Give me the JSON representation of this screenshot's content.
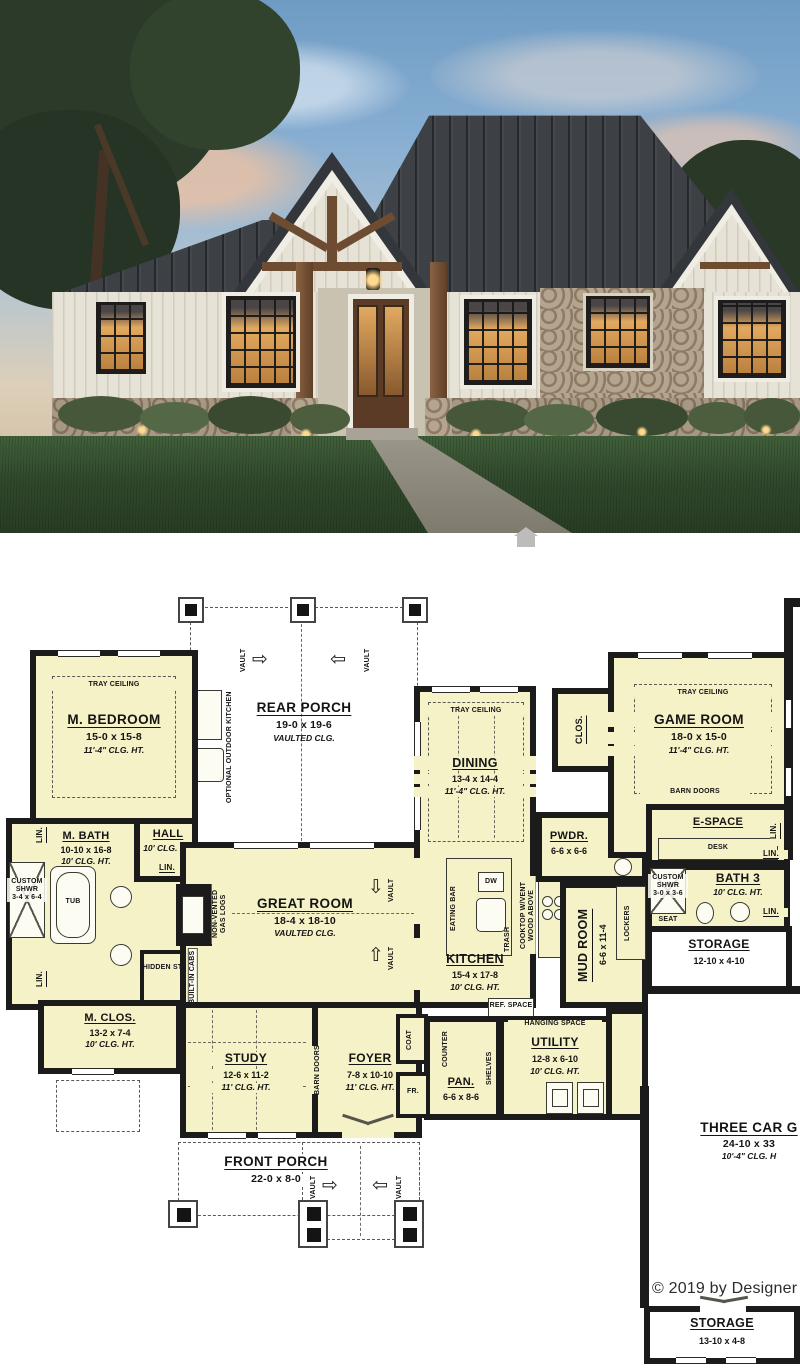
{
  "photo": {
    "description": "Dusk exterior rendering of a modern farmhouse ranch house with dark metal roof, white board-and-batten siding, timber porch and stone accents",
    "palette": {
      "sky_top": "#6f9cc4",
      "sky_horizon": "#e5d3b8",
      "roof": "#3d4145",
      "siding": "#e6e2d6",
      "stone": "#998672",
      "lawn": "#2f4629",
      "window_glow": "#dda55c",
      "timber": "#7a553a"
    },
    "watermark_icon": "house-icon"
  },
  "plan": {
    "wall_color": "#1b1b1b",
    "room_fill": "#f5f2c7",
    "rooms": {
      "m_bedroom": {
        "name": "M. BEDROOM",
        "dim": "15-0 x 15-8",
        "clg": "11'-4\" CLG. HT.",
        "ceiling": "TRAY CEILING"
      },
      "rear_porch": {
        "name": "REAR PORCH",
        "dim": "19-0 x 19-6",
        "clg": "VAULTED CLG."
      },
      "dining": {
        "name": "DINING",
        "dim": "13-4 x 14-4",
        "clg": "11'-4\" CLG. HT.",
        "ceiling": "TRAY CEILING"
      },
      "game_room": {
        "name": "GAME ROOM",
        "dim": "18-0 x 15-0",
        "clg": "11'-4\" CLG. HT.",
        "ceiling": "TRAY CEILING"
      },
      "m_bath": {
        "name": "M. BATH",
        "dim": "10-10 x 16-8",
        "clg": "10' CLG. HT."
      },
      "hall": {
        "name": "HALL",
        "clg": "10' CLG. HT."
      },
      "great_room": {
        "name": "GREAT ROOM",
        "dim": "18-4 x 18-10",
        "clg": "VAULTED CLG."
      },
      "kitchen": {
        "name": "KITCHEN",
        "dim": "15-4 x 17-8",
        "clg": "10' CLG. HT."
      },
      "mud_room": {
        "name": "MUD ROOM",
        "dim": "6-6 x 11-4"
      },
      "pwdr": {
        "name": "PWDR.",
        "dim": "6-6 x 6-6"
      },
      "e_space": {
        "name": "E-SPACE"
      },
      "bath3": {
        "name": "BATH 3",
        "clg": "10' CLG. HT."
      },
      "storage_right": {
        "name": "STORAGE",
        "dim": "12-10 x 4-10"
      },
      "m_clos": {
        "name": "M. CLOS.",
        "dim": "13-2 x 7-4",
        "clg": "10' CLG. HT."
      },
      "study": {
        "name": "STUDY",
        "dim": "12-6 x 11-2",
        "clg": "11' CLG. HT."
      },
      "foyer": {
        "name": "FOYER",
        "dim": "7-8 x 10-10",
        "clg": "11' CLG. HT."
      },
      "pan": {
        "name": "PAN.",
        "dim": "6-6 x 8-6"
      },
      "utility": {
        "name": "UTILITY",
        "dim": "12-8 x 6-10",
        "clg": "10' CLG. HT."
      },
      "front_porch": {
        "name": "FRONT PORCH",
        "dim": "22-0 x 8-0"
      },
      "garage": {
        "name": "THREE CAR G",
        "dim": "24-10 x 33",
        "clg": "10'-4\" CLG. H"
      },
      "storage_bottom": {
        "name": "STORAGE",
        "dim": "13-10 x 4-8"
      }
    },
    "labels": {
      "tray_ceiling": "TRAY CEILING",
      "lin": "LIN.",
      "vault": "VAULT",
      "custom_shwr": "CUSTOM SHWR",
      "shwr_m_dim": "3-4 x 6-4",
      "shwr3_dim": "3-0 x 3-6",
      "tub": "TUB",
      "hidden_stor": "HIDDEN STOR.",
      "non_vented": "NON-VENTED GAS LOGS",
      "built_in_cabs": "BUILT-IN CABS",
      "optional_outdoor_kitchen": "OPTIONAL OUTDOOR KITCHEN",
      "barn_doors": "BARN DOORS",
      "desk": "DESK",
      "seat": "SEAT",
      "lockers": "LOCKERS",
      "eating_bar": "EATING BAR",
      "dw": "DW",
      "trash": "TRASH",
      "cooktop": "COOKTOP W/VENT WOOD ABOVE",
      "oven_micro": "OVEN/ MICRO",
      "ref_space": "REF. SPACE",
      "hanging_space": "HANGING SPACE",
      "counter": "COUNTER",
      "shelves": "SHELVES",
      "coat": "COAT",
      "fr": "FR.",
      "clos": "CLOS.",
      "arrow_right": "⇨",
      "arrow_left": "⇦",
      "arrow_up": "⇧",
      "arrow_down": "⇩"
    },
    "copyright": "© 2019 by Designer"
  }
}
